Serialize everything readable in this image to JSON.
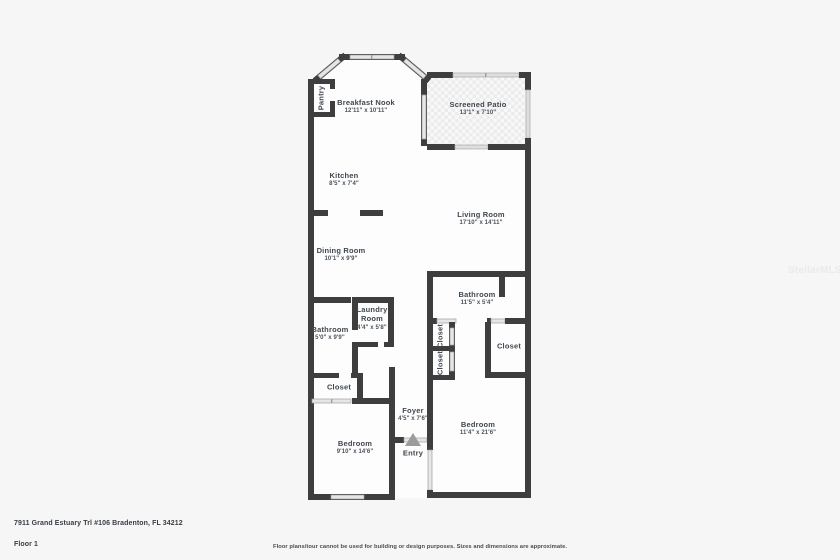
{
  "page": {
    "watermark": "StellarMLS"
  },
  "colors": {
    "background": "#f6f6f6",
    "wall": "#3e3e3e",
    "floor": "#fdfdfd",
    "window": "#e6e6e6",
    "label_text": "#40474f",
    "entry_arrow": "#9c9c9c",
    "patio_hatch": "#ececec",
    "watermark": "#eaeaea"
  },
  "rooms": [
    {
      "name": "Breakfast Nook",
      "dims": "12'11\" x 10'11\""
    },
    {
      "name": "Screened Patio",
      "dims": "13'1\" x 7'10\""
    },
    {
      "name": "Kitchen",
      "dims": "8'5\" x 7'4\""
    },
    {
      "name": "Living Room",
      "dims": "17'10\" x 14'11\""
    },
    {
      "name": "Dining Room",
      "dims": "10'1\" x 9'9\""
    },
    {
      "name": "Pantry"
    },
    {
      "name": "Bathroom",
      "dims": "5'0\" x 9'9\""
    },
    {
      "name": "Laundry Room",
      "dims": "4'4\" x 5'8\""
    },
    {
      "name": "Bathroom",
      "dims": "11'5\" x 5'4\""
    },
    {
      "name": "Closet"
    },
    {
      "name": "Closet"
    },
    {
      "name": "Closet"
    },
    {
      "name": "Closet"
    },
    {
      "name": "Foyer",
      "dims": "4'5\" x 7'6\""
    },
    {
      "name": "Bedroom",
      "dims": "9'10\" x 14'6\""
    },
    {
      "name": "Bedroom",
      "dims": "11'4\" x 21'6\""
    },
    {
      "name": "Entry"
    }
  ],
  "footer": {
    "address": "7911 Grand Estuary Trl #106 Bradenton, FL 34212",
    "floor": "Floor 1",
    "disclaimer": "Floor plans/tour cannot be used for building or design purposes. Sizes and dimensions are approximate."
  }
}
